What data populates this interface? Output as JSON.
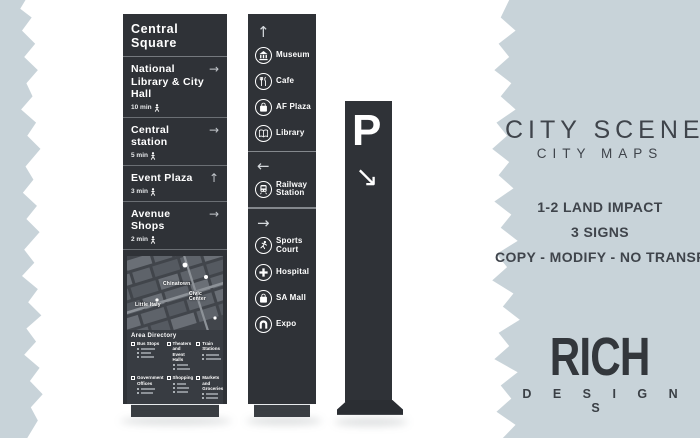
{
  "colors": {
    "paper": "#ffffff",
    "band": "#c8d3d9",
    "pillar": "#2f3237",
    "panel_text": "#3f444b"
  },
  "left_sign": {
    "title": "Central Square",
    "entries": [
      {
        "name": "National Library & City Hall",
        "time": "10 min",
        "arrow": "→"
      },
      {
        "name": "Central station",
        "time": "5 min",
        "arrow": "→"
      },
      {
        "name": "Event Plaza",
        "time": "3 min",
        "arrow": "↑"
      },
      {
        "name": "Avenue Shops",
        "time": "2 min",
        "arrow": "→"
      }
    ],
    "map": {
      "labels": {
        "0": "Chinatown",
        "1": "Civic Center",
        "2": "Little Italy"
      },
      "directory_title": "Area Directory",
      "categories": {
        "0": "Bus Stops",
        "1": "Theaters and Event Halls",
        "2": "Train Stations",
        "3": "Government Offices",
        "4": "Shopping",
        "5": "Markets and Groceries"
      }
    }
  },
  "middle_sign": {
    "sections": [
      {
        "arrow": "↑",
        "items": [
          {
            "icon": "museum-icon",
            "label": "Museum"
          },
          {
            "icon": "cafe-icon",
            "label": "Cafe"
          },
          {
            "icon": "shopping-bag-icon",
            "label": "AF Plaza"
          },
          {
            "icon": "book-icon",
            "label": "Library"
          }
        ]
      },
      {
        "arrow": "←",
        "items": [
          {
            "icon": "train-icon",
            "label": "Railway Station"
          }
        ]
      },
      {
        "arrow": "→",
        "items": [
          {
            "icon": "runner-icon",
            "label": "Sports Court"
          },
          {
            "icon": "cross-icon",
            "label": "Hospital"
          },
          {
            "icon": "shopping-bag-icon",
            "label": "SA Mall"
          },
          {
            "icon": "arch-icon",
            "label": "Expo"
          }
        ]
      }
    ]
  },
  "parking_sign": {
    "letter": "P",
    "arrow": "↘"
  },
  "right_panel": {
    "title": "CITY SCENES",
    "subtitle": "CITY MAPS",
    "lines": {
      "0": "1-2 LAND IMPACT",
      "1": "3 SIGNS",
      "2": "COPY - MODIFY - NO TRANSFER"
    },
    "brand": {
      "name": "RICH",
      "sub": "D E S I G N S"
    }
  }
}
